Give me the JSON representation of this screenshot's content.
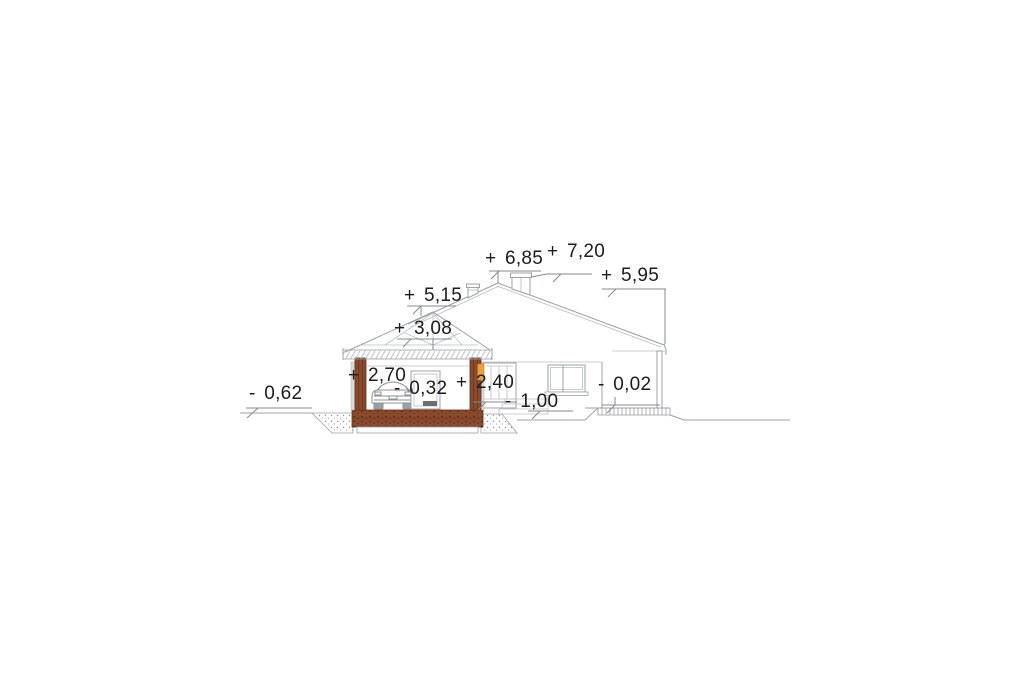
{
  "page": {
    "background": "#ffffff",
    "description": "Architectural side elevation / cross-section of a single family house with garage, with level dimension marks in meters"
  },
  "drawing": {
    "levels": {
      "ground_left": "- 0,62",
      "garage_ridge": "+ 5,15",
      "garage_gable": "+ 3,08",
      "garage_ceiling": "+ 2,70",
      "garage_floor": "- 0,32",
      "door_top": "+ 2,40",
      "terrace": "- 1,00",
      "main_ridge": "+ 6,85",
      "chimney_top": "+ 7,20",
      "eave_right": "+ 5,95",
      "porch_floor": "- 0,02"
    },
    "colors": {
      "wall_section_brown": "#8a4a2e",
      "accent_orange": "#e8a23c",
      "line_gray": "#9ba0a8",
      "text": "#1c1c1c"
    }
  }
}
